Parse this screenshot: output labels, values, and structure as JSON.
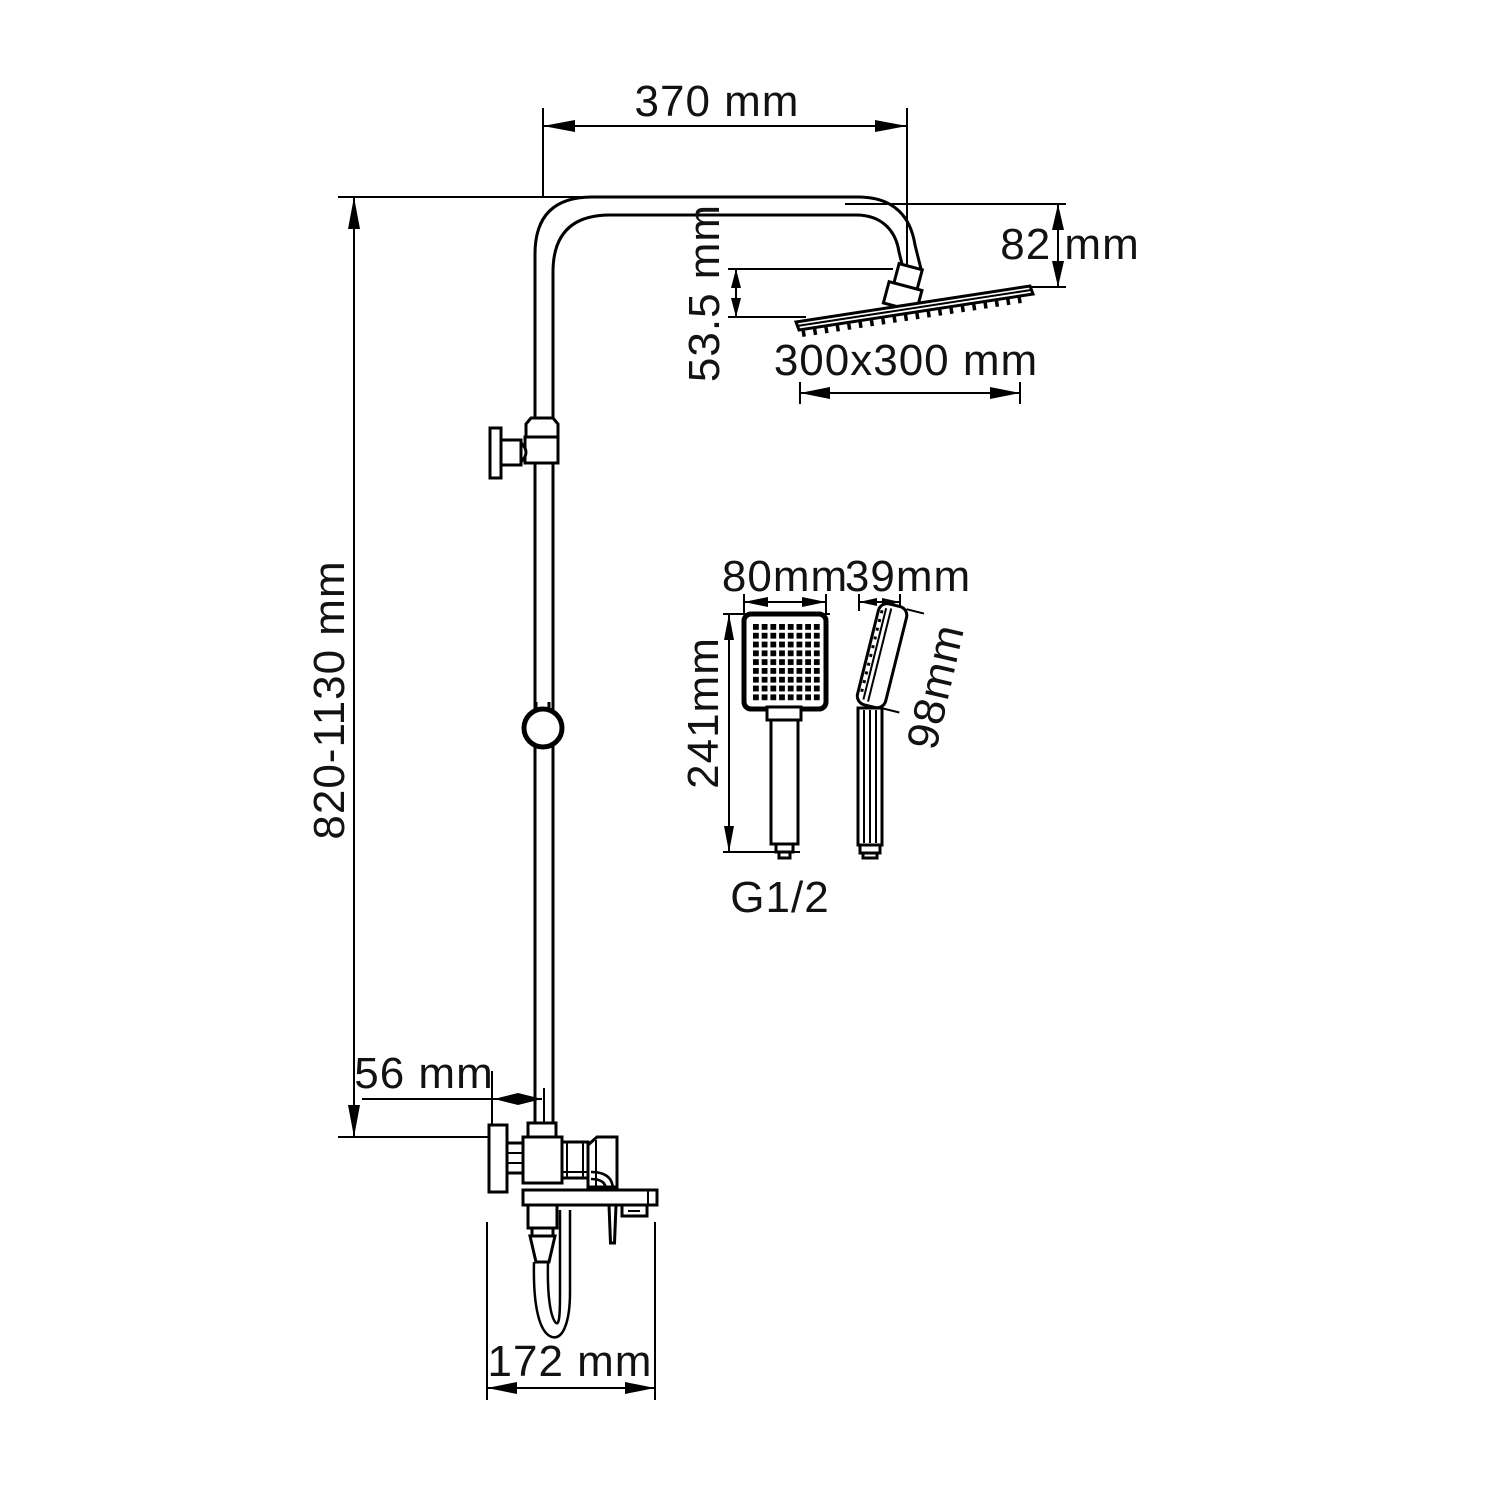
{
  "diagram": {
    "type": "technical-dimension-drawing",
    "subject": "shower-column-system",
    "background": "#ffffff",
    "line_color": "#000000",
    "labels": {
      "top_width": "370 mm",
      "head_drop": "82 mm",
      "head_offset": "53.5 mm",
      "head_size": "300x300 mm",
      "column_height": "820-1130 mm",
      "wall_offset": "56 mm",
      "spout_reach": "172 mm",
      "handshower_width": "80mm",
      "handshower_length": "241mm",
      "handshower_depth": "39mm",
      "handshower_face": "98mm",
      "thread": "G1/2"
    }
  }
}
